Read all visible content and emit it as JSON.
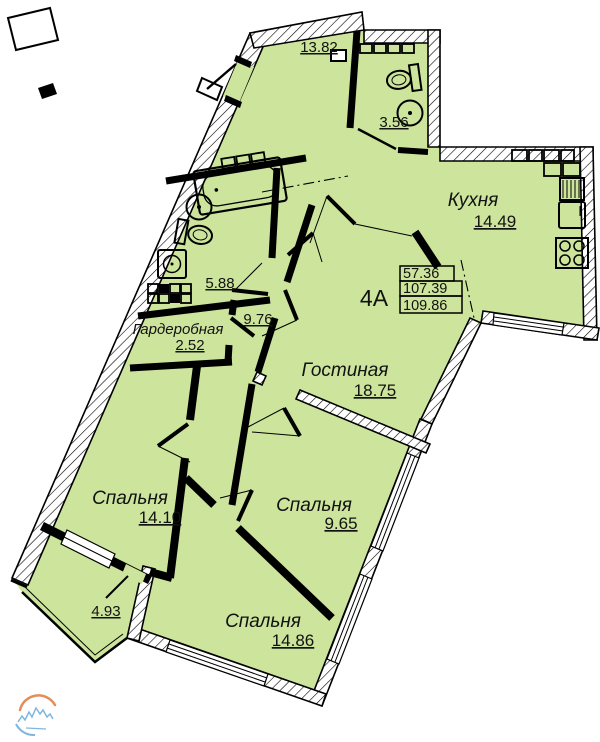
{
  "unit": {
    "label": "4А",
    "area_living": "57.36",
    "area_total": "107.39",
    "area_overall": "109.86"
  },
  "rooms": [
    {
      "key": "hallway",
      "name": "",
      "area": "13.82"
    },
    {
      "key": "wc",
      "name": "",
      "area": "3.56"
    },
    {
      "key": "kitchen",
      "name": "Кухня",
      "area": "14.49"
    },
    {
      "key": "bathroom",
      "name": "",
      "area": "5.88"
    },
    {
      "key": "wardrobe",
      "name": "Гардеробная",
      "area": "2.52"
    },
    {
      "key": "corridor",
      "name": "",
      "area": "9.76"
    },
    {
      "key": "living",
      "name": "Гостиная",
      "area": "18.75"
    },
    {
      "key": "bedroom1",
      "name": "Спальня",
      "area": "14.10"
    },
    {
      "key": "bedroom2",
      "name": "Спальня",
      "area": "9.65"
    },
    {
      "key": "bedroom3",
      "name": "Спальня",
      "area": "14.86"
    },
    {
      "key": "balcony",
      "name": "",
      "area": "4.93"
    }
  ],
  "colors": {
    "floor_fill": "#cce49c",
    "line": "#000000",
    "logo_blue": "#6aa9d8",
    "logo_orange": "#e07a3f"
  }
}
